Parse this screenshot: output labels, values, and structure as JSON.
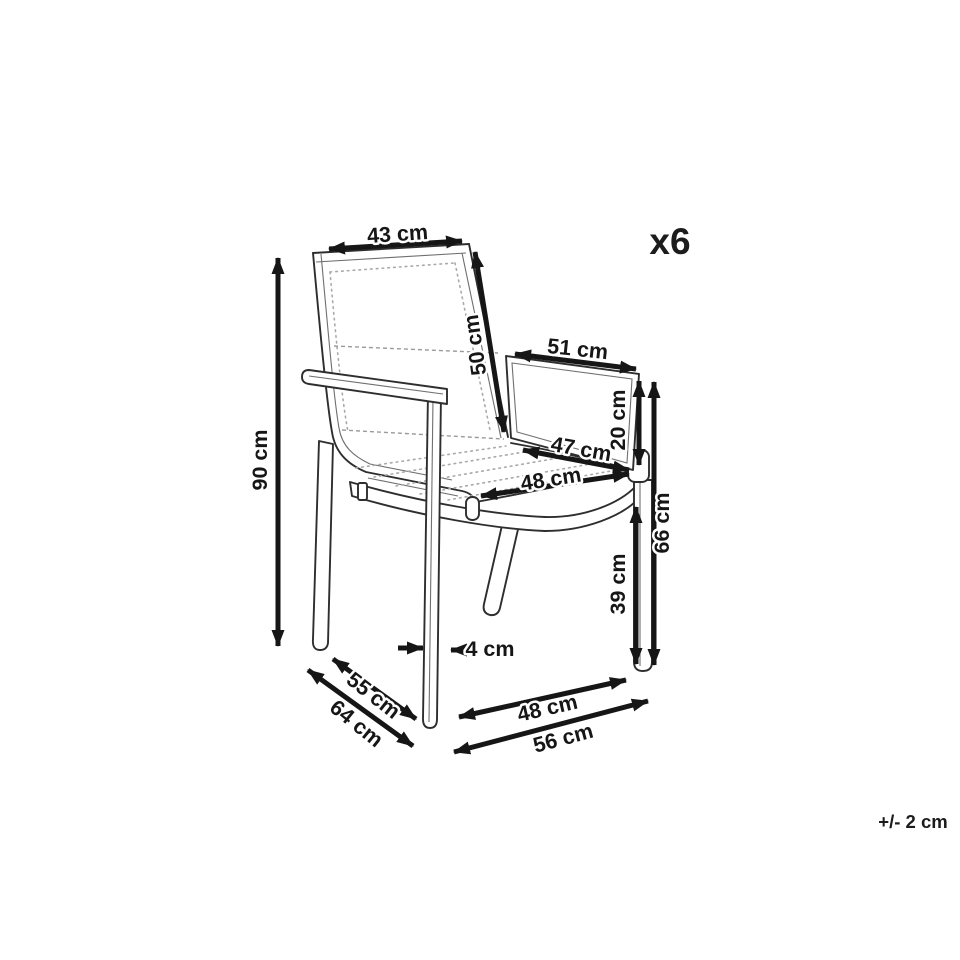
{
  "meta": {
    "quantity_label": "x6",
    "tolerance_note": "+/- 2 cm"
  },
  "dims": {
    "back_width": "43 cm",
    "back_height": "50 cm",
    "armrest_length": "51 cm",
    "armrest_drop": "20 cm",
    "seat_depth": "47 cm",
    "seat_width": "48 cm",
    "armrest_height": "66 cm",
    "seat_height": "39 cm",
    "total_height": "90 cm",
    "frame_thickness": "4 cm",
    "footprint_depth_inner": "55 cm",
    "total_depth": "64 cm",
    "base_width_inner": "48 cm",
    "total_width": "56 cm"
  },
  "colors": {
    "dimension_lines": "#161616",
    "chair_outline": "#2e2e2e",
    "fabric_dots": "#a9a9a9",
    "background": "#ffffff"
  }
}
